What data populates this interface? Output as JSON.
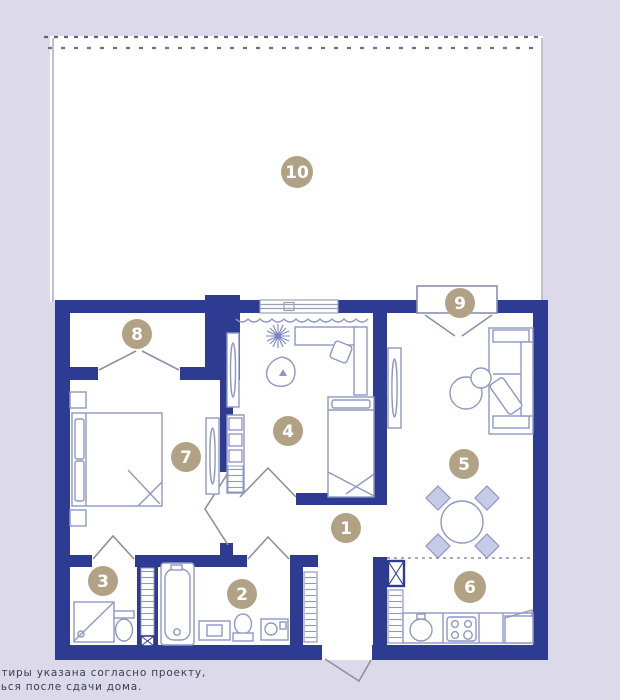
{
  "plan": {
    "title_hint": "apartment floor plan with roof terrace",
    "badges": {
      "b1": "1",
      "b2": "2",
      "b3": "3",
      "b4": "4",
      "b5": "5",
      "b6": "6",
      "b7": "7",
      "b8": "8",
      "b9": "9",
      "b10": "10"
    },
    "footer": {
      "line1": "ртиры указана согласно проекту,",
      "line2": "ться после сдачи дома."
    },
    "colors": {
      "background": "#dbd9ea",
      "walls": "#2d3b92",
      "furniture_outline": "#8f97c4",
      "badge_fill": "#b2a285",
      "badge_text": "#ffffff",
      "terrace_outline": "#9aa0b4",
      "dash_line": "#5f6486"
    }
  }
}
